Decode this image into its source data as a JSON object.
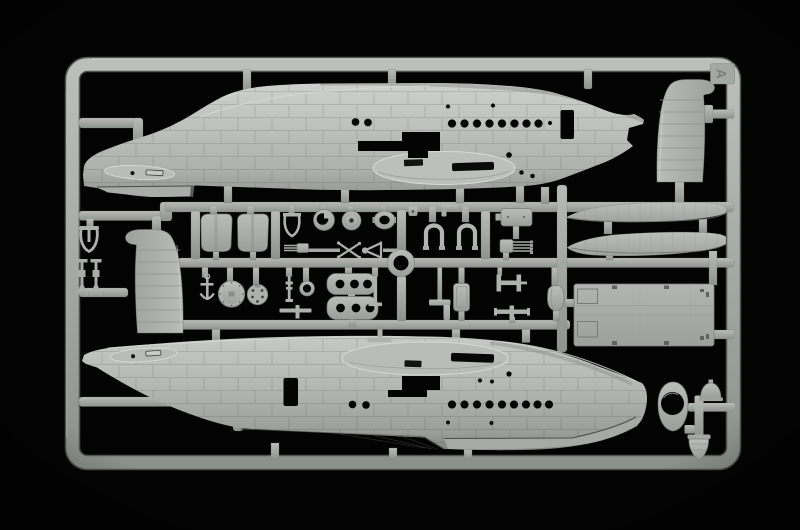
{
  "scene": {
    "type": "photograph",
    "subject": "injection-molded plastic model kit sprue (flying-boat aircraft kit)",
    "description": "Light grey polystyrene sprue frame photographed on a black background. It holds two large flying-boat fuselage halves, two vertical tail fin halves, two long wing-float halves, a rectangular interior deck panel, a turret fairing with a round opening and two rows of small detail parts in the middle.",
    "background_color": "#000000",
    "plastic_color": "#b6b9b6",
    "plastic_highlight_color": "#d2d4d2",
    "plastic_shadow_color": "#7c807d"
  },
  "sprue": {
    "gate_label": "A",
    "parts": [
      {
        "name": "fuselage half, upper",
        "position": "top"
      },
      {
        "name": "fuselage half, lower",
        "position": "bottom"
      },
      {
        "name": "vertical fin half",
        "position": "top right"
      },
      {
        "name": "vertical fin half",
        "position": "middle left"
      },
      {
        "name": "wing float half",
        "position": "right, upper"
      },
      {
        "name": "wing float half",
        "position": "right, lower"
      },
      {
        "name": "interior deck panel",
        "position": "right, lower middle"
      },
      {
        "name": "turret fairing with round opening",
        "position": "bottom right"
      },
      {
        "name": "dome part",
        "position": "bottom right"
      },
      {
        "name": "tail cone",
        "position": "bottom right"
      },
      {
        "name": "cowling shell pair",
        "position": "center row 1"
      },
      {
        "name": "control yoke",
        "position": "far left"
      },
      {
        "name": "machine gun",
        "position": "far left"
      },
      {
        "name": "machine gun",
        "position": "far left"
      },
      {
        "name": "wishbone bracket",
        "position": "center row 1"
      },
      {
        "name": "notched ring",
        "position": "center row 1"
      },
      {
        "name": "disc",
        "position": "center row 1"
      },
      {
        "name": "oval ring",
        "position": "center row 1"
      },
      {
        "name": "gun breech with barrels",
        "position": "center row 1"
      },
      {
        "name": "X cross brace",
        "position": "center row 1"
      },
      {
        "name": "arrow brace",
        "position": "center row 1"
      },
      {
        "name": "U bracket",
        "position": "center row 1"
      },
      {
        "name": "U bracket",
        "position": "center row 1"
      },
      {
        "name": "equipment box",
        "position": "center row 1"
      },
      {
        "name": "quad gun barrels",
        "position": "center row 1"
      },
      {
        "name": "anchor",
        "position": "center row 2"
      },
      {
        "name": "bulkhead disc",
        "position": "center row 2"
      },
      {
        "name": "instrument disc",
        "position": "center row 2"
      },
      {
        "name": "small ring",
        "position": "center row 2"
      },
      {
        "name": "perforated plate",
        "position": "center row 2"
      },
      {
        "name": "perforated plate",
        "position": "center row 2"
      },
      {
        "name": "seat",
        "position": "center row 2"
      },
      {
        "name": "L bracket",
        "position": "center row 2"
      },
      {
        "name": "H bracket",
        "position": "center row 2"
      },
      {
        "name": "cross fitting",
        "position": "center row 2"
      },
      {
        "name": "curved fairing",
        "position": "center row 2"
      },
      {
        "name": "mooring ring",
        "position": "center"
      }
    ]
  }
}
